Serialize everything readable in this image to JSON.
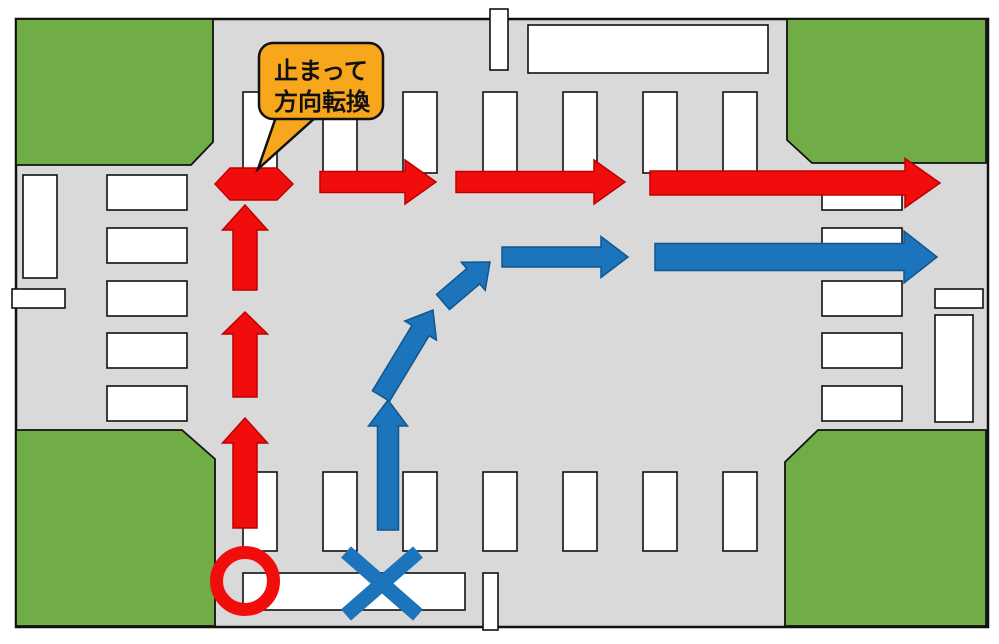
{
  "canvas": {
    "w": 999,
    "h": 644,
    "margin_bg": "#ffffff"
  },
  "road": {
    "x": 16,
    "y": 19,
    "w": 972,
    "h": 608,
    "fill": "#d9d9d9",
    "stroke": "#111111",
    "stroke_width": 2.5
  },
  "green_blocks": {
    "fill": "#70ad47",
    "stroke": "#111111",
    "stroke_width": 1.8,
    "shapes": [
      {
        "name": "corner-block-top-left",
        "points": [
          [
            16,
            19
          ],
          [
            213,
            19
          ],
          [
            213,
            142
          ],
          [
            191,
            165
          ],
          [
            16,
            165
          ]
        ]
      },
      {
        "name": "corner-block-top-right",
        "points": [
          [
            787,
            19
          ],
          [
            986,
            19
          ],
          [
            986,
            163
          ],
          [
            812,
            163
          ],
          [
            787,
            140
          ]
        ]
      },
      {
        "name": "corner-block-bottom-left",
        "points": [
          [
            16,
            430
          ],
          [
            182,
            430
          ],
          [
            215,
            459
          ],
          [
            215,
            626
          ],
          [
            16,
            626
          ]
        ]
      },
      {
        "name": "corner-block-bottom-right",
        "points": [
          [
            818,
            430
          ],
          [
            986,
            430
          ],
          [
            986,
            626
          ],
          [
            785,
            626
          ],
          [
            785,
            462
          ]
        ]
      }
    ]
  },
  "road_markings": {
    "fill": "#ffffff",
    "stroke": "#111111",
    "stroke_width": 1.6,
    "crosswalk_north": {
      "y": 92,
      "h": 81,
      "w": 34,
      "xs": [
        243,
        323,
        403,
        483,
        563,
        643,
        723
      ]
    },
    "crosswalk_south": {
      "y": 472,
      "h": 79,
      "w": 34,
      "xs": [
        243,
        323,
        403,
        483,
        563,
        643,
        723
      ]
    },
    "crosswalk_west": {
      "x": 107,
      "w": 80,
      "h": 35,
      "ys": [
        175,
        228,
        281,
        333,
        386
      ]
    },
    "crosswalk_east": {
      "x": 822,
      "w": 80,
      "h": 35,
      "ys": [
        175,
        228,
        281,
        333,
        386
      ]
    },
    "rects": [
      {
        "name": "north-road-median-mark",
        "x": 490,
        "y": 9,
        "w": 18,
        "h": 61
      },
      {
        "name": "north-sidewalk-line",
        "x": 528,
        "y": 25,
        "w": 240,
        "h": 48
      },
      {
        "name": "west-stop-line",
        "x": 23,
        "y": 175,
        "w": 34,
        "h": 103
      },
      {
        "name": "west-road-median-mark",
        "x": 12,
        "y": 289,
        "w": 53,
        "h": 19
      },
      {
        "name": "east-road-median-mark",
        "x": 935,
        "y": 289,
        "w": 48,
        "h": 19
      },
      {
        "name": "east-stop-line",
        "x": 935,
        "y": 315,
        "w": 38,
        "h": 107
      },
      {
        "name": "south-sidewalk-line",
        "x": 243,
        "y": 573,
        "w": 222,
        "h": 37
      },
      {
        "name": "south-road-median-mark",
        "x": 483,
        "y": 573,
        "w": 15,
        "h": 57
      }
    ]
  },
  "red_route": {
    "fill": "#f20d0d",
    "stroke": "#c00000",
    "stroke_width": 1.5,
    "start_marker": {
      "type": "circle",
      "cx": 245,
      "cy": 581,
      "r": 28.5,
      "ring_width": 13
    },
    "stop_marker": {
      "type": "hexagon",
      "points": [
        [
          215,
          184
        ],
        [
          230,
          168
        ],
        [
          277,
          168
        ],
        [
          293,
          184
        ],
        [
          277,
          200
        ],
        [
          230,
          200
        ]
      ]
    },
    "arrows": [
      {
        "name": "red-arrow-up-1",
        "x1": 245,
        "y1": 528,
        "x2": 245,
        "y2": 418,
        "shaft": 24,
        "head_w": 45,
        "head_l": 25
      },
      {
        "name": "red-arrow-up-2",
        "x1": 245,
        "y1": 397,
        "x2": 245,
        "y2": 312,
        "shaft": 24,
        "head_w": 45,
        "head_l": 22
      },
      {
        "name": "red-arrow-up-3",
        "x1": 245,
        "y1": 290,
        "x2": 245,
        "y2": 205,
        "shaft": 24,
        "head_w": 45,
        "head_l": 25
      },
      {
        "name": "red-arrow-right-1",
        "x1": 320,
        "y1": 182,
        "x2": 436,
        "y2": 182,
        "shaft": 21,
        "head_w": 44,
        "head_l": 31
      },
      {
        "name": "red-arrow-right-2",
        "x1": 456,
        "y1": 182,
        "x2": 625,
        "y2": 182,
        "shaft": 21,
        "head_w": 44,
        "head_l": 31
      },
      {
        "name": "red-arrow-right-3",
        "x1": 650,
        "y1": 183,
        "x2": 940,
        "y2": 183,
        "shaft": 24,
        "head_w": 49,
        "head_l": 35
      }
    ]
  },
  "blue_route": {
    "fill": "#1b74bc",
    "stroke": "#10568f",
    "stroke_width": 1.5,
    "start_marker": {
      "type": "cross",
      "lines": [
        [
          346,
          552,
          418,
          615
        ],
        [
          346,
          615,
          418,
          552
        ]
      ],
      "width": 15
    },
    "arrows": [
      {
        "name": "blue-arrow-up",
        "x1": 388,
        "y1": 530,
        "x2": 388,
        "y2": 400,
        "shaft": 21,
        "head_w": 39,
        "head_l": 26
      },
      {
        "name": "blue-arrow-diagonal-1",
        "x1": 381,
        "y1": 396,
        "x2": 433,
        "y2": 310,
        "shaft": 20,
        "head_w": 37,
        "head_l": 24
      },
      {
        "name": "blue-arrow-diagonal-2",
        "x1": 443,
        "y1": 302,
        "x2": 490,
        "y2": 262,
        "shaft": 20,
        "head_w": 37,
        "head_l": 22
      },
      {
        "name": "blue-arrow-right-1",
        "x1": 502,
        "y1": 257,
        "x2": 628,
        "y2": 257,
        "shaft": 20,
        "head_w": 41,
        "head_l": 27
      },
      {
        "name": "blue-arrow-right-2",
        "x1": 655,
        "y1": 257,
        "x2": 937,
        "y2": 257,
        "shaft": 27,
        "head_w": 52,
        "head_l": 33
      }
    ]
  },
  "callout": {
    "line1": "止まって",
    "line2": "方向転換",
    "fill": "#f8a71d",
    "stroke": "#111111",
    "text_color": "#111111",
    "box": {
      "x": 259,
      "y": 43,
      "w": 124,
      "h": 76,
      "rx": 14
    },
    "tail": [
      [
        276,
        117
      ],
      [
        316,
        117
      ],
      [
        258,
        169
      ]
    ]
  }
}
